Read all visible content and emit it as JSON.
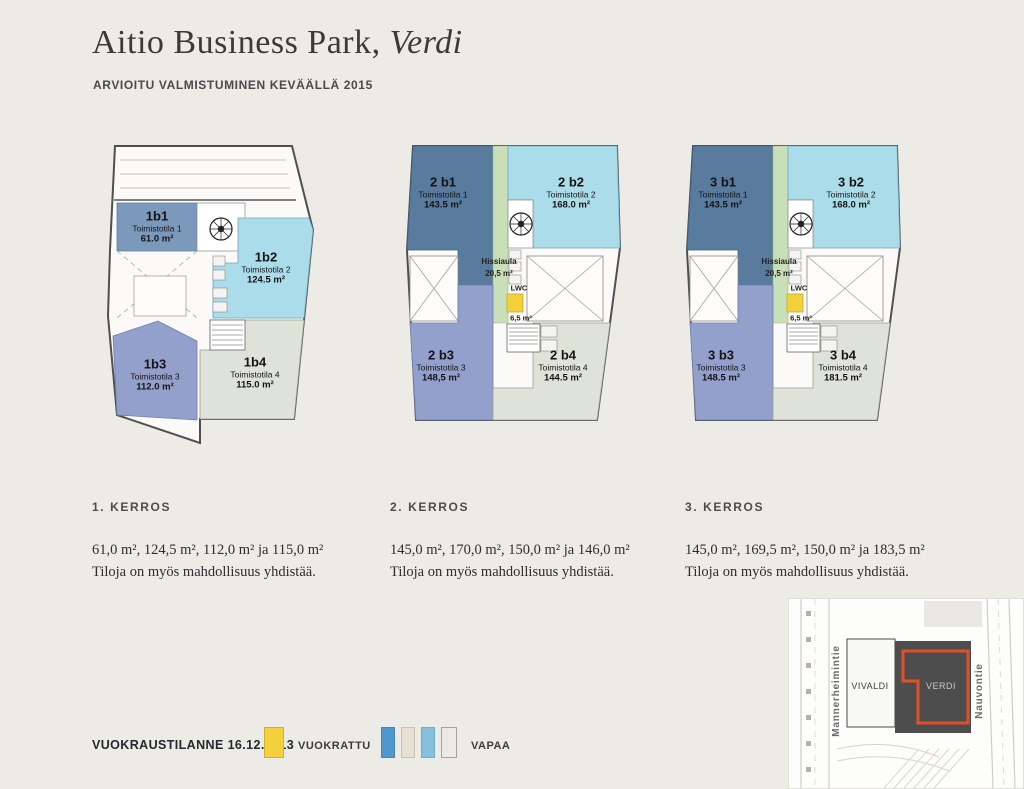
{
  "page": {
    "title": "Aitio Business Park,",
    "title_em": "Verdi",
    "subtitle": "ARVIOITU VALMISTUMINEN KEVÄÄLLÄ 2015"
  },
  "floors": [
    {
      "heading": "1. KERROS",
      "areas": "61,0 m², 124,5 m², 112,0 m² ja 115,0 m²",
      "note": "Tiloja on myös mahdollisuus yhdistää.",
      "units": [
        {
          "code": "1b1",
          "name": "Toimistotila 1",
          "area": "61.0 m²"
        },
        {
          "code": "1b2",
          "name": "Toimistotila 2",
          "area": "124.5 m²"
        },
        {
          "code": "1b3",
          "name": "Toimistotila 3",
          "area": "112.0 m²"
        },
        {
          "code": "1b4",
          "name": "Toimistotila 4",
          "area": "115.0 m²"
        }
      ]
    },
    {
      "heading": "2. KERROS",
      "areas": "145,0 m², 170,0 m², 150,0 m² ja 146,0 m²",
      "note": "Tiloja on myös mahdollisuus yhdistää.",
      "units": [
        {
          "code": "2 b1",
          "name": "Toimistotila 1",
          "area": "143.5 m²"
        },
        {
          "code": "2 b2",
          "name": "Toimistotila 2",
          "area": "168.0 m²"
        },
        {
          "code": "2 b3",
          "name": "Toimistotila 3",
          "area": "148,5 m²"
        },
        {
          "code": "2 b4",
          "name": "Toimistotila 4",
          "area": "144.5 m²"
        }
      ],
      "hissiaula": {
        "label": "Hissiaula",
        "area": "20,5 m²"
      },
      "lwc": {
        "label": "LWC",
        "area": "6,5 m²"
      }
    },
    {
      "heading": "3. KERROS",
      "areas": "145,0 m², 169,5 m², 150,0 m² ja 183,5 m²",
      "note": "Tiloja on myös mahdollisuus yhdistää.",
      "units": [
        {
          "code": "3 b1",
          "name": "Toimistotila 1",
          "area": "143.5 m²"
        },
        {
          "code": "3 b2",
          "name": "Toimistotila 2",
          "area": "168.0 m²"
        },
        {
          "code": "3 b3",
          "name": "Toimistotila 3",
          "area": "148.5 m²"
        },
        {
          "code": "3 b4",
          "name": "Toimistotila 4",
          "area": "181.5 m²"
        }
      ],
      "hissiaula": {
        "label": "Hissiaula",
        "area": "20,5 m²"
      },
      "lwc": {
        "label": "LWC",
        "area": "6,5 m²"
      }
    }
  ],
  "legend": {
    "status": "VUOKRAUSTILANNE 16.12.2013",
    "rented": "VUOKRATTU",
    "free": "VAPAA"
  },
  "map": {
    "street_left": "Mannerheimintie",
    "street_right": "Nauvontie",
    "building_a": "VIVALDI",
    "building_b": "VERDI"
  },
  "colors": {
    "unit_1b1_blue": "#7b99ba",
    "unit_b1_dark_blue": "#587b9e",
    "unit_b2_light_blue": "#abdcea",
    "unit_b3_periwinkle": "#93a0cb",
    "unit_b4_gray": "#dfe2d8",
    "hissiaula_green": "#c9dfb8",
    "rented_yellow": "#f2d13d",
    "free_swatch_blue": "#4f97cf",
    "free_swatch_beige": "#e7e1d3",
    "free_swatch_lightblue": "#85c1dd",
    "free_swatch_gray": "#eceae4",
    "verdi_outline_orange": "#e0512a"
  }
}
